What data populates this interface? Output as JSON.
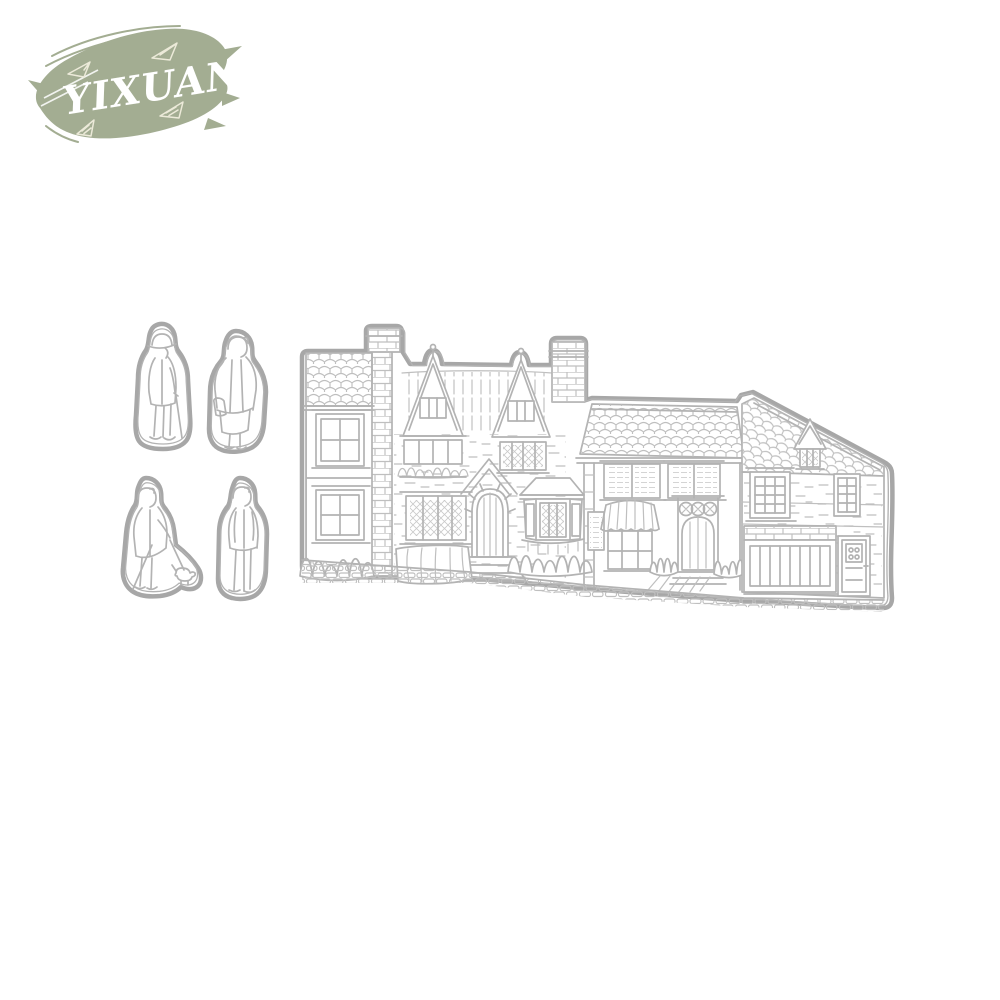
{
  "brand": {
    "name": "YIXUAN"
  },
  "colors": {
    "background": "#ffffff",
    "brand_green": "#a3ad92",
    "logo_text": "#ffffff",
    "logo_doodle": "#ecead9",
    "die_line": "#b3b3b3",
    "die_line_soft": "#bfbfbf",
    "die_outline": "#a7a7a7"
  },
  "art": {
    "pieces": [
      {
        "label": "man-with-cap-and-cane-die"
      },
      {
        "label": "woman-with-handbag-die"
      },
      {
        "label": "woman-walking-dog-die"
      },
      {
        "label": "standing-man-die"
      },
      {
        "label": "village-street-houses-die"
      }
    ]
  }
}
